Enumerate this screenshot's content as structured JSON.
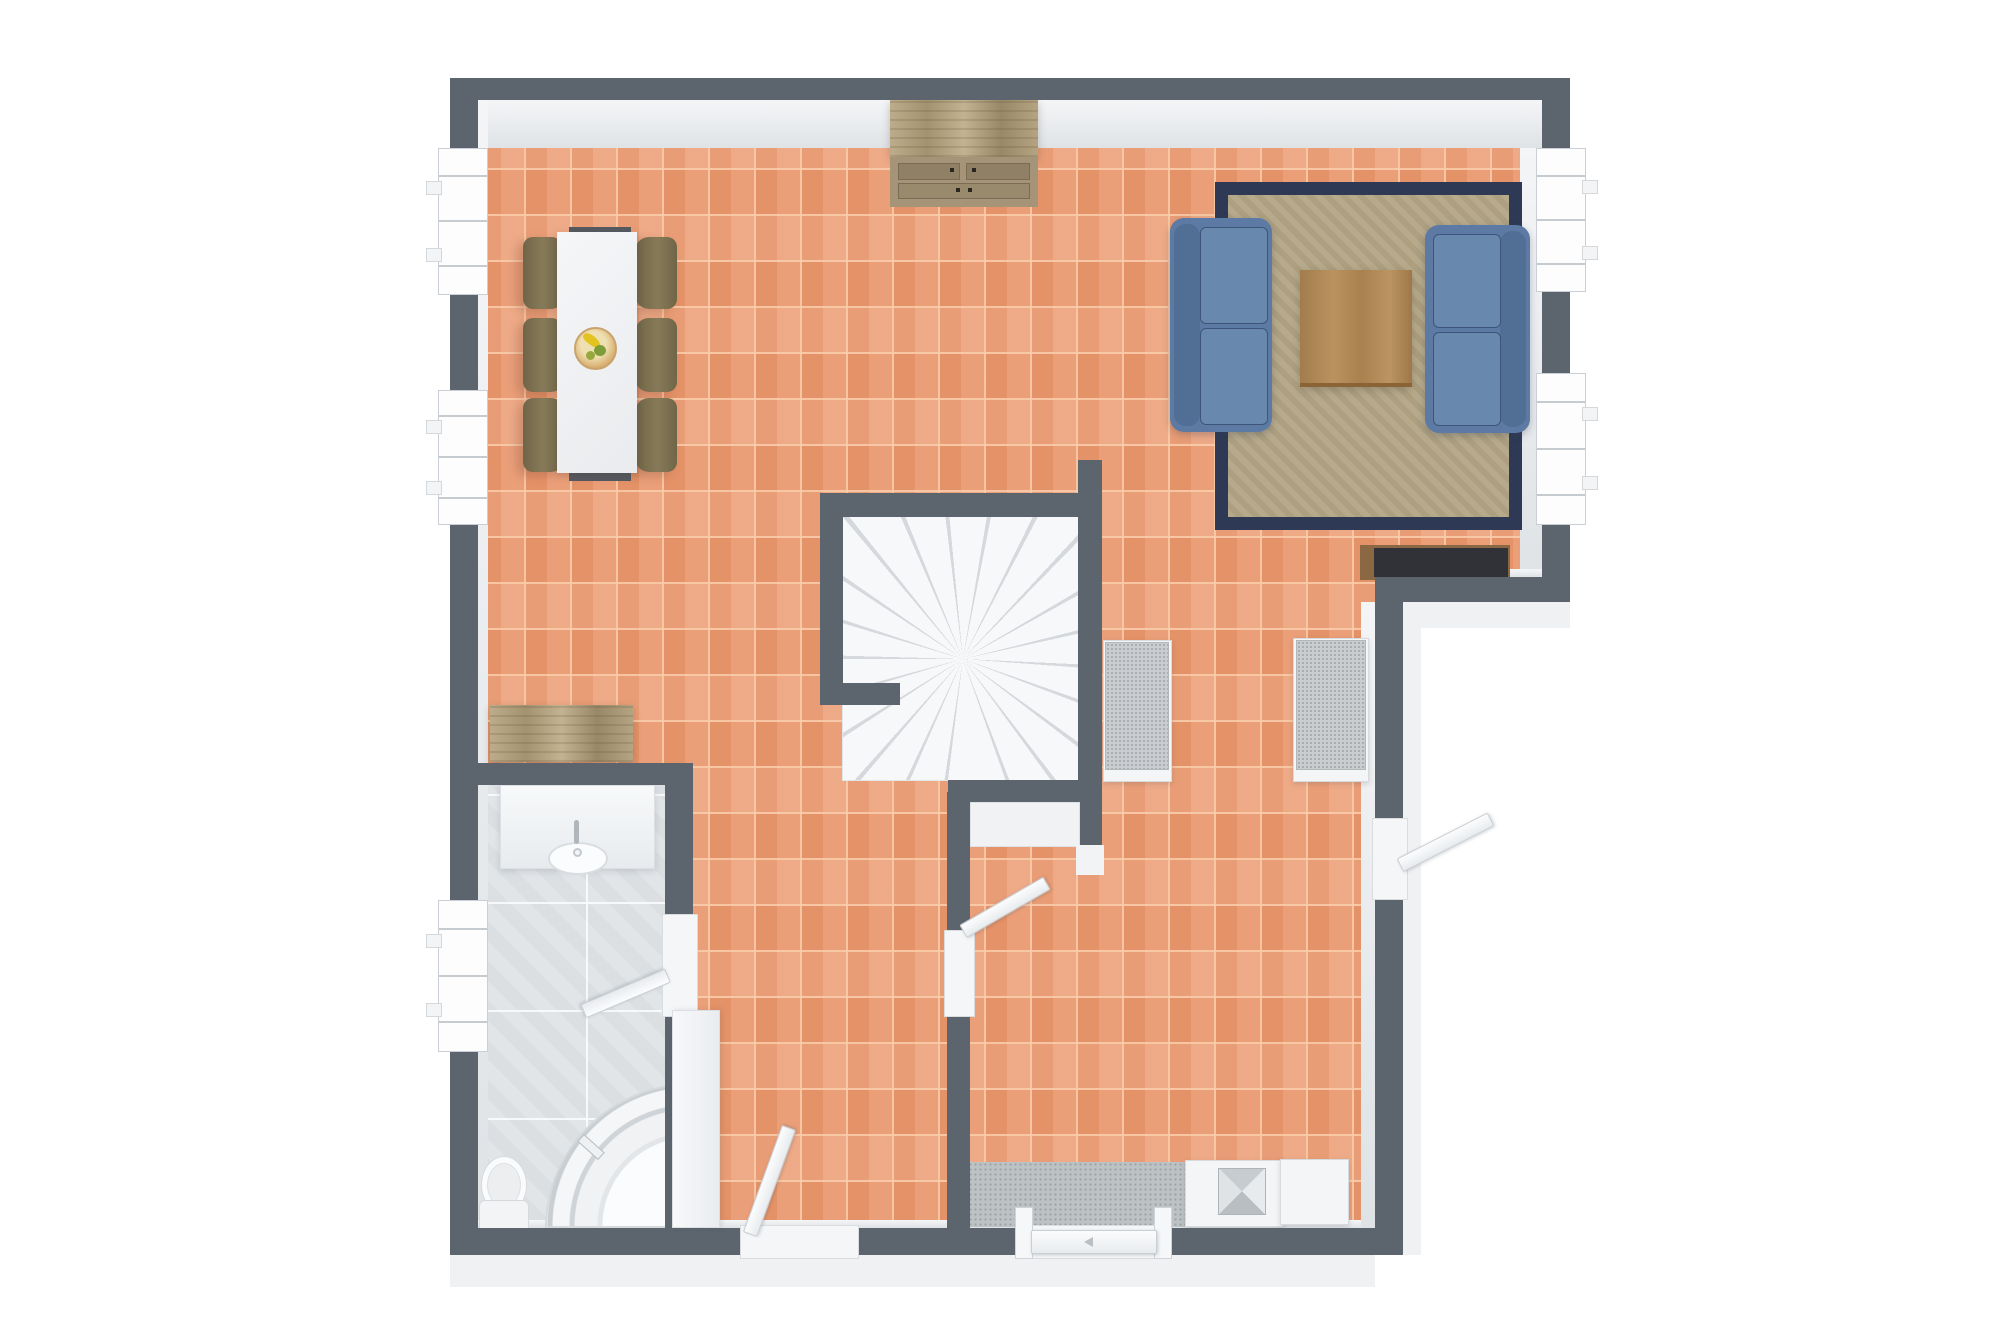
{
  "meta": {
    "content_type": "3d-floor-plan-render",
    "view": "top-down",
    "visible_text": "none",
    "canvas": {
      "width": 2000,
      "height": 1333
    }
  },
  "palette": {
    "wall": "#5c646e",
    "wall_inner_face": "#e9ecef",
    "floor_tile_terracotta": "#eb9a71",
    "floor_grout_terracotta": "#facdab",
    "floor_tile_bath": "#e0e4e7",
    "stair_white": "#f6f7f9",
    "rug_beige": "#b3a585",
    "rug_border_navy": "#2e3a55",
    "sofa_blue": "#5c7aa3",
    "coffee_table_wood": "#b08a5a",
    "rustic_wood": "#b0a07e",
    "chair_olive": "#877a58",
    "tv_console_dark": "#303237",
    "doormat_gray": "#bdc2c4",
    "fixture_white": "#f4f6f7"
  },
  "rooms": {
    "dining_area": {
      "label": "Dining area",
      "floor": "terracotta tile"
    },
    "living_area": {
      "label": "Living area",
      "floor": "terracotta tile"
    },
    "hallway": {
      "label": "Hallway with benches",
      "floor": "terracotta tile"
    },
    "entry_hall": {
      "label": "Entry hall",
      "floor": "terracotta tile"
    },
    "bedroom": {
      "label": "Bedroom (middle room)",
      "floor": "terracotta tile"
    },
    "bathroom": {
      "label": "Bathroom",
      "floor": "gray tile"
    },
    "staircase": {
      "label": "Winder staircase",
      "treads": 14
    }
  },
  "furniture": {
    "dining_table": {
      "label": "Dining table, white, seats 6"
    },
    "dining_chair": {
      "label": "Dining chair, olive"
    },
    "fruit_bowl": {
      "label": "Fruit bowl with bananas and green fruit"
    },
    "sideboard": {
      "label": "Rustic wood sideboard with drawers"
    },
    "console_bench": {
      "label": "Rustic wood bench"
    },
    "rug": {
      "label": "Beige area rug with navy border"
    },
    "sofa_left": {
      "label": "Two-seat sofa, blue fabric"
    },
    "sofa_right": {
      "label": "Two-seat sofa, blue fabric"
    },
    "coffee_table": {
      "label": "Square wood coffee table"
    },
    "tv_console": {
      "label": "Low media console, dark top"
    },
    "hall_bench_left": {
      "label": "Hall bench, gray cushion"
    },
    "hall_bench_right": {
      "label": "Hall bench, gray cushion"
    },
    "doormat": {
      "label": "Gray doormat"
    },
    "entry_cabinet_1": {
      "label": "Entry cabinet with metal tray"
    },
    "entry_cabinet_2": {
      "label": "Entry cabinet, white"
    },
    "wardrobe": {
      "label": "White wardrobe"
    },
    "vanity": {
      "label": "Bathroom vanity with basin and faucet"
    },
    "toilet": {
      "label": "Toilet"
    },
    "shower": {
      "label": "Corner shower with curved glass"
    }
  },
  "doors": {
    "bedroom_exterior": {
      "label": "Exterior door, bottom wall, ajar into bedroom"
    },
    "main_entrance": {
      "label": "Main entrance door, closed, bottom wall"
    },
    "side_exterior": {
      "label": "Side exterior door, right wall, open outward"
    },
    "bedroom_to_hall": {
      "label": "Interior door, open into hallway"
    },
    "bathroom_door": {
      "label": "Bathroom door, open into bathroom"
    }
  },
  "windows": {
    "left_1": {
      "label": "Double casement window, left wall upper"
    },
    "left_2": {
      "label": "Double casement window, left wall mid"
    },
    "left_3": {
      "label": "Bathroom window, left wall lower"
    },
    "right_1": {
      "label": "Double casement window, right wall upper"
    },
    "right_2": {
      "label": "Double casement window, right wall mid"
    }
  },
  "icons": {
    "door_swing_arrow": "small gray arrow marker on entrance door"
  }
}
